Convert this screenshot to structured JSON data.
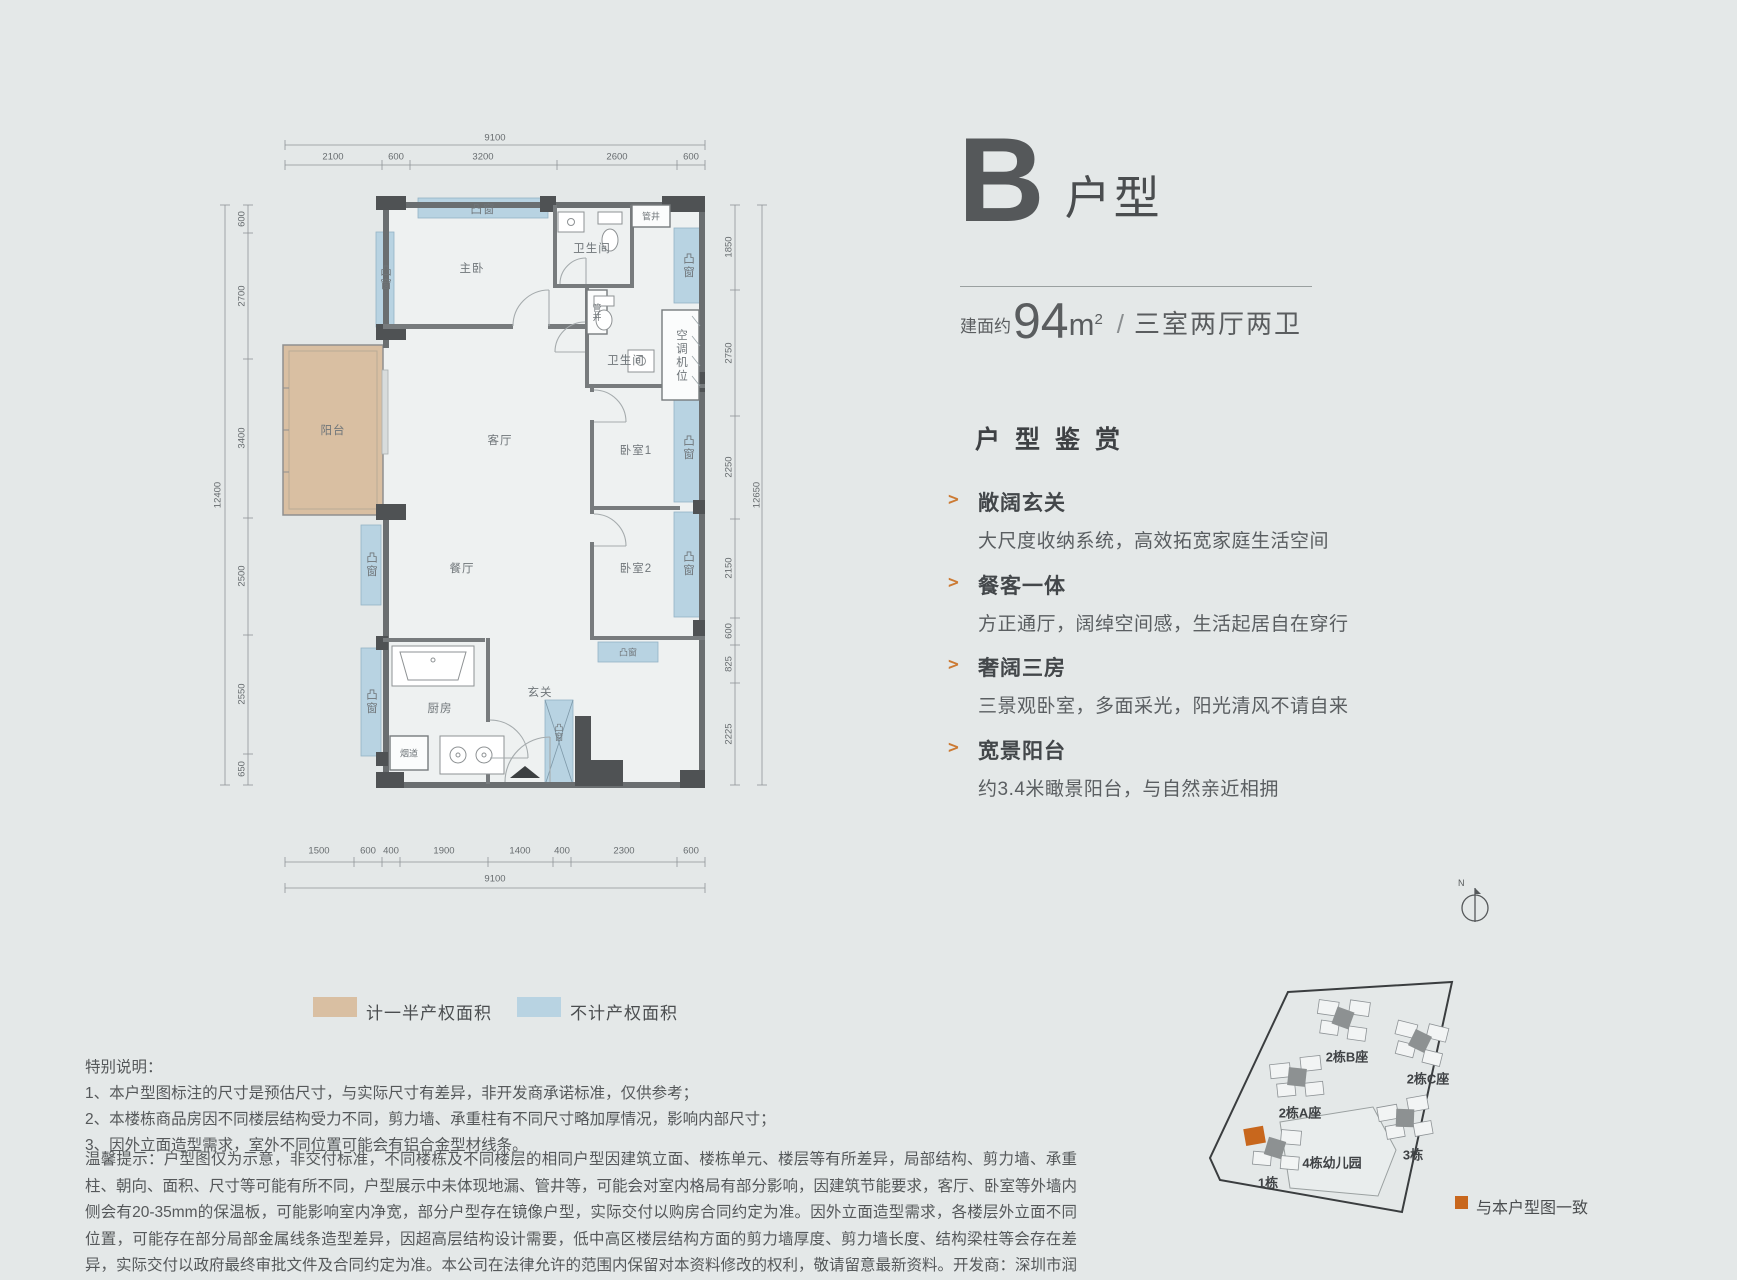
{
  "unit": {
    "letter": "B",
    "type_label": "户型",
    "area_prefix": "建面约",
    "area_value": "94",
    "area_unit": "m",
    "area_sup": "2",
    "divider": "/",
    "rooms_label": "三室两厅两卫"
  },
  "appreciation": {
    "heading": "户型鉴赏",
    "bullet": ">",
    "items": [
      {
        "title": "敞阔玄关",
        "desc": "大尺度收纳系统，高效拓宽家庭生活空间"
      },
      {
        "title": "餐客一体",
        "desc": "方正通厅，阔绰空间感，生活起居自在穿行"
      },
      {
        "title": "奢阔三房",
        "desc": "三景观卧室，多面采光，阳光清风不请自来"
      },
      {
        "title": "宽景阳台",
        "desc": "约3.4米瞰景阳台，与自然亲近相拥"
      }
    ]
  },
  "legend": {
    "half_property": "计一半产权面积",
    "no_property": "不计产权面积",
    "half_color": "#d9bfa2",
    "no_color": "#b8d3e2"
  },
  "plan": {
    "labels": {
      "master": "主卧",
      "living": "客厅",
      "dining": "餐厅",
      "kitchen": "厨房",
      "foyer": "玄关",
      "bedroom1": "卧室1",
      "bedroom2": "卧室2",
      "bath": "卫生间",
      "balcony": "阳台",
      "bay_window": "凸窗",
      "pipe_shaft": "管井",
      "ac_unit": "空调机位",
      "flue": "烟道"
    },
    "dims": {
      "top_total": "9100",
      "top_segments": [
        "2100",
        "600",
        "3200",
        "2600",
        "600"
      ],
      "left_total": "12400",
      "left_segments": [
        "600",
        "2700",
        "3400",
        "2500",
        "2550",
        "650"
      ],
      "right_total": "12650",
      "right_segments": [
        "1850",
        "2750",
        "2250",
        "2150",
        "600",
        "825",
        "2225"
      ],
      "bottom_total": "9100",
      "bottom_segments": [
        "1500",
        "600",
        "400",
        "1900",
        "1400",
        "400",
        "2300",
        "600"
      ]
    }
  },
  "site_plan": {
    "buildings": [
      "2栋B座",
      "2栋A座",
      "2栋C座",
      "3栋",
      "1栋",
      "4栋幼儿园"
    ],
    "north": "N",
    "legend": "与本户型图一致",
    "highlight_color": "#c8671d"
  },
  "notes": {
    "title": "特别说明：",
    "items": [
      "1、本户型图标注的尺寸是预估尺寸，与实际尺寸有差异，非开发商承诺标准，仅供参考；",
      "2、本楼栋商品房因不同楼层结构受力不同，剪力墙、承重柱有不同尺寸略加厚情况，影响内部尺寸；",
      "3、因外立面造型需求，室外不同位置可能会有铝合金型材线条。"
    ]
  },
  "disclaimer": "温馨提示：户型图仅为示意，非交付标准，不同楼栋及不同楼层的相同户型因建筑立面、楼栋单元、楼层等有所差异，局部结构、剪力墙、承重柱、朝向、面积、尺寸等可能有所不同，户型展示中未体现地漏、管井等，可能会对室内格局有部分影响，因建筑节能要求，客厅、卧室等外墙内侧会有20-35mm的保温板，可能影响室内净宽，部分户型存在镜像户型，实际交付以购房合同约定为准。因外立面造型需求，各楼层外立面不同位置，可能存在部分局部金属线条造型差异，因超高层结构设计需要，低中高区楼层结构方面的剪力墙厚度、剪力墙长度、结构梁柱等会存在差异，实际交付以政府最终审批文件及合同约定为准。本公司在法律允许的范围内保留对本资料修改的权利，敬请留意最新资料。开发商：深圳市润宏房地产有限公司；推广名：润宏城；首批推售宗地备案名：润雅园；代理商：无；制作日期：2023年10月。"
}
